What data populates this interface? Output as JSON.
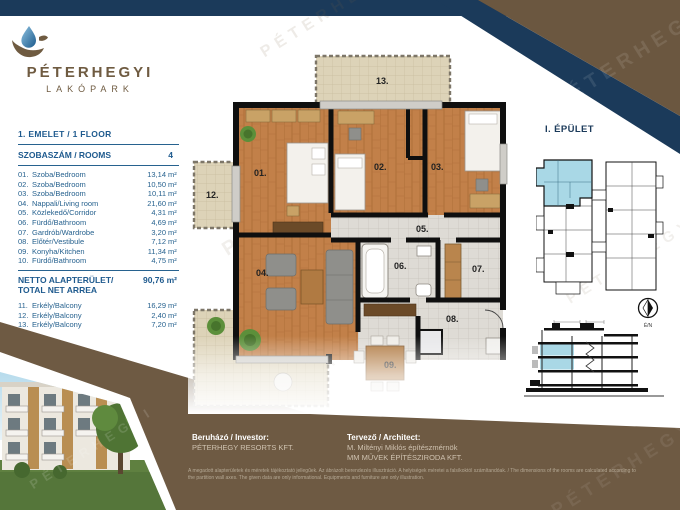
{
  "logo": {
    "title": "PÉTERHEGYI",
    "subtitle": "LAKÓPARK"
  },
  "left_panel": {
    "floor_header": "1. EMELET / 1 FLOOR",
    "rooms_header": {
      "label": "SZOBASZÁM / ROOMS",
      "value": "4"
    },
    "unit": "m²",
    "rooms": [
      {
        "no": "01.",
        "name": "Szoba/Bedroom",
        "area": "13,14"
      },
      {
        "no": "02.",
        "name": "Szoba/Bedroom",
        "area": "10,50"
      },
      {
        "no": "03.",
        "name": "Szoba/Bedroom",
        "area": "10,11"
      },
      {
        "no": "04.",
        "name": "Nappali/Living room",
        "area": "21,60"
      },
      {
        "no": "05.",
        "name": "Közlekedő/Corridor",
        "area": "4,31"
      },
      {
        "no": "06.",
        "name": "Fürdő/Bathroom",
        "area": "4,69"
      },
      {
        "no": "07.",
        "name": "Gardrób/Wardrobe",
        "area": "3,20"
      },
      {
        "no": "08.",
        "name": "Előtér/Vestibule",
        "area": "7,12"
      },
      {
        "no": "09.",
        "name": "Konyha/Kitchen",
        "area": "11,34"
      },
      {
        "no": "10.",
        "name": "Fürdő/Bathroom",
        "area": "4,75"
      }
    ],
    "net_area": {
      "label_line1": "NETTO ALAPTERÜLET/",
      "label_line2": "TOTAL NET ARREA",
      "value": "90,76 m²"
    },
    "balconies": [
      {
        "no": "11.",
        "name": "Erkély/Balcony",
        "area": "16,29"
      },
      {
        "no": "12.",
        "name": "Erkély/Balcony",
        "area": "2,40"
      },
      {
        "no": "13.",
        "name": "Erkély/Balcony",
        "area": "7,20"
      }
    ]
  },
  "floor_plan": {
    "labels": {
      "r01": "01.",
      "r02": "02.",
      "r03": "03.",
      "r04": "04.",
      "r05": "05.",
      "r06": "06.",
      "r07": "07.",
      "r08": "08.",
      "r09": "09.",
      "b12": "12.",
      "b13": "13."
    }
  },
  "right_panel": {
    "building_title": "I. ÉPÜLET",
    "compass_label": "É/N"
  },
  "footer": {
    "investor_label": "Beruházó / Investor:",
    "investor_value": "PÉTERHEGY RESORTS KFT.",
    "architect_label": "Tervező / Architect:",
    "architect_value1": "M. Miltényi Miklós építészmérnök",
    "architect_value2": "MM MŰVEK ÉPÍTÉSZIRODA KFT.",
    "disclaimer_line1": "A megadott alapterületek és méretek tájékoztató jellegűek. Az ábrázolt berendezés illusztráció. A helyiségek méretei a falsíkoktól számítandóak. / The dimensions of the rooms are calculated according to",
    "disclaimer_line2": "the partition wall axes. The given data are only informational. Equipments and furniture are only illustration."
  },
  "colors": {
    "navy": "#1b3a5a",
    "blue_text": "#27628f",
    "bar_brown": "#6e5a43",
    "corner_brown": "#6b5740",
    "logo_brown": "#6f5b41",
    "highlight_blue": "#a9d8e6"
  },
  "watermark": {
    "word1": "PÉTERHEGYI",
    "word2": "LAKÓPARK"
  }
}
